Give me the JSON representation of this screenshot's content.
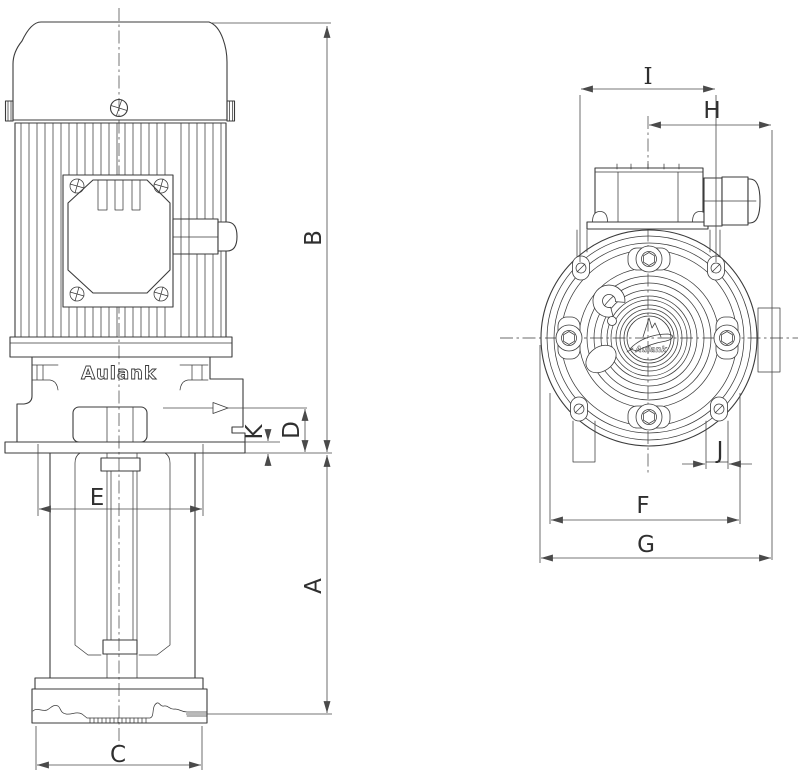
{
  "colors": {
    "ink": "#3b3b3b",
    "dimension": "#4a4a4a",
    "background": "#ffffff"
  },
  "brand": "Aulank",
  "logo_text": "Aulank",
  "labels": {
    "A": "A",
    "B": "B",
    "C": "C",
    "D": "D",
    "E": "E",
    "F": "F",
    "G": "G",
    "H": "H",
    "I": "I",
    "J": "J",
    "K": "K"
  }
}
